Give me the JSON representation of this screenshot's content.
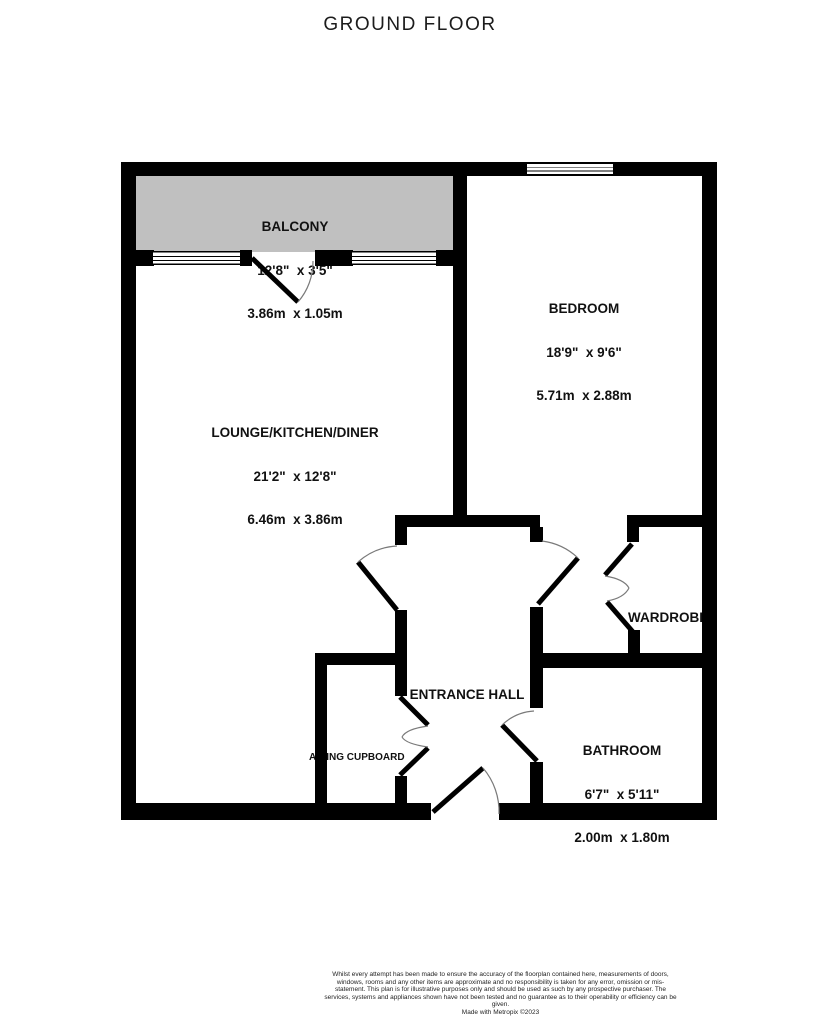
{
  "title": "GROUND FLOOR",
  "rooms": {
    "balcony": {
      "name": "BALCONY",
      "imperial": "12'8\"  x 3'5\"",
      "metric": "3.86m  x 1.05m"
    },
    "lounge": {
      "name": "LOUNGE/KITCHEN/DINER",
      "imperial": "21'2\"  x 12'8\"",
      "metric": "6.46m  x 3.86m"
    },
    "bedroom": {
      "name": "BEDROOM",
      "imperial": "18'9\"  x 9'6\"",
      "metric": "5.71m  x 2.88m"
    },
    "bathroom": {
      "name": "BATHROOM",
      "imperial": "6'7\"  x 5'11\"",
      "metric": "2.00m  x 1.80m"
    },
    "entrance_hall": {
      "name": "ENTRANCE HALL"
    },
    "wardrobe": {
      "name": "WARDROBE"
    },
    "airing_cupboard": {
      "name": "AIRING CUPBOARD"
    }
  },
  "footer": {
    "disclaimer": "Whilst every attempt has been made to ensure the accuracy of the floorplan contained here, measurements of doors, windows, rooms and any other items are approximate and no responsibility is taken for any error, omission or mis-statement. This plan is for illustrative purposes only and should be used as such by any prospective purchaser. The services, systems and appliances shown have not been tested and no guarantee as to their operability or efficiency can be given.",
    "credit": "Made with Metropix ©2023"
  },
  "colors": {
    "wall": "#000000",
    "balcony_fill": "#c0c0c0",
    "text": "#111111",
    "door_arc": "#7a7a7a",
    "background": "#ffffff"
  }
}
